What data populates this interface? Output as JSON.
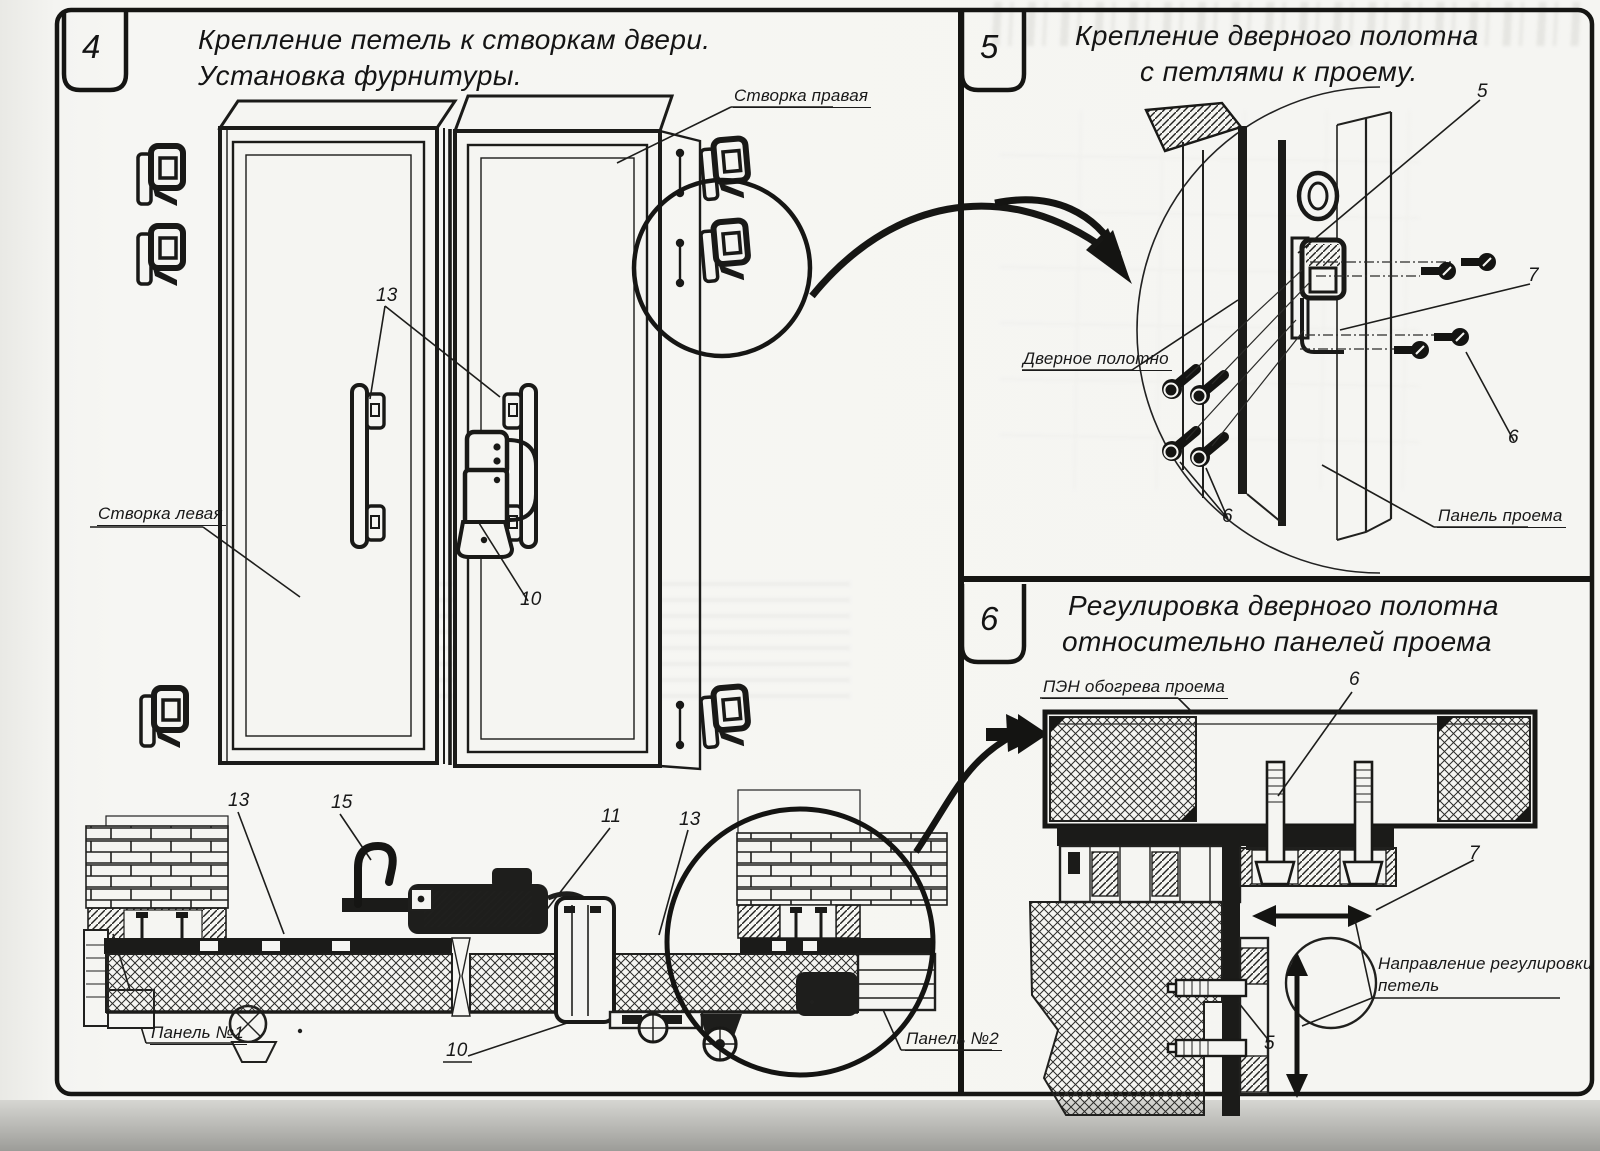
{
  "sheet": {
    "background": "#f5f5f2",
    "line_color": "#1b1b1b",
    "ghost_color": "#e8e8e4"
  },
  "panels": [
    {
      "number": "4",
      "title_lines": [
        "Крепление петель к створкам двери.",
        "Установка фурнитуры."
      ]
    },
    {
      "number": "5",
      "title_lines": [
        "Крепление дверного полотна",
        "с петлями к проему."
      ]
    },
    {
      "number": "6",
      "title_lines": [
        "Регулировка дверного полотна",
        "относительно панелей проема"
      ]
    }
  ],
  "labels": {
    "p4": {
      "stvorka_pravaya": "Створка правая",
      "stvorka_levaya": "Створка левая",
      "n13_top": "13",
      "n10_mid": "10",
      "n13_bottom_left": "13",
      "n15": "15",
      "n11": "11",
      "n13_bottom_right": "13",
      "panel_no1": "Панель №1",
      "n10_bottom": "10",
      "panel_no2": "Панель №2"
    },
    "p5": {
      "n5": "5",
      "n7": "7",
      "n6_right": "6",
      "n6_left": "6",
      "dvernoe_polotno": "Дверное полотно",
      "panel_proema": "Панель проема"
    },
    "p6": {
      "pen_obogreva": "ПЭН обогрева проема",
      "n6": "6",
      "n7": "7",
      "n5": "5",
      "napravlenie_line1": "Направление регулировки",
      "napravlenie_line2": "петель"
    }
  }
}
